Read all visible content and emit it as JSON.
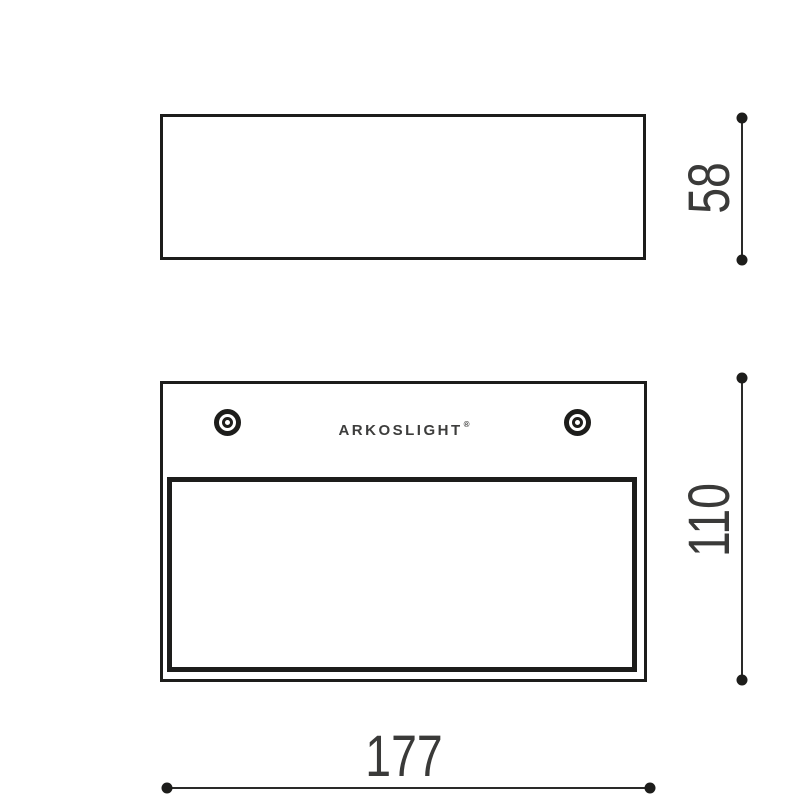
{
  "brand": {
    "name": "ARKOSLIGHT",
    "registered_mark": "®"
  },
  "dimensions": {
    "side_height": "58",
    "front_height": "110",
    "front_width": "177"
  },
  "colors": {
    "line": "#1d1d1b",
    "dimension_text": "#3a3a39",
    "logo_text": "#3d3d3c",
    "background": "#ffffff"
  }
}
